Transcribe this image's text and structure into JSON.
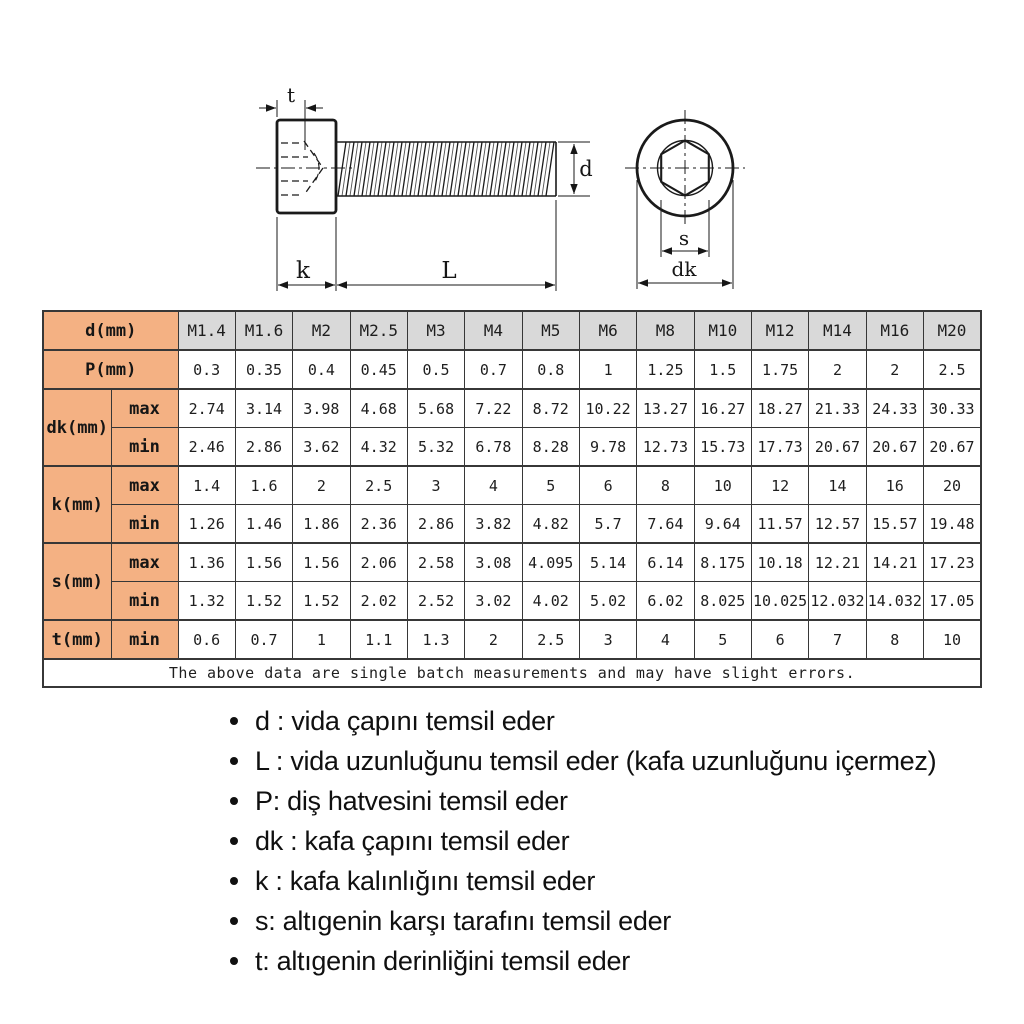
{
  "diagram": {
    "labels": {
      "t": "t",
      "d": "d",
      "k": "k",
      "L": "L",
      "s": "s",
      "dk": "dk"
    }
  },
  "table": {
    "header": {
      "label": "d(mm)",
      "sizes": [
        "M1.4",
        "M1.6",
        "M2",
        "M2.5",
        "M3",
        "M4",
        "M5",
        "M6",
        "M8",
        "M10",
        "M12",
        "M14",
        "M16",
        "M20"
      ]
    },
    "rows": [
      {
        "label": "P(mm)",
        "sub": null,
        "values": [
          "0.3",
          "0.35",
          "0.4",
          "0.45",
          "0.5",
          "0.7",
          "0.8",
          "1",
          "1.25",
          "1.5",
          "1.75",
          "2",
          "2",
          "2.5"
        ]
      },
      {
        "label": "dk(mm)",
        "sub": "max",
        "values": [
          "2.74",
          "3.14",
          "3.98",
          "4.68",
          "5.68",
          "7.22",
          "8.72",
          "10.22",
          "13.27",
          "16.27",
          "18.27",
          "21.33",
          "24.33",
          "30.33"
        ]
      },
      {
        "label": null,
        "sub": "min",
        "values": [
          "2.46",
          "2.86",
          "3.62",
          "4.32",
          "5.32",
          "6.78",
          "8.28",
          "9.78",
          "12.73",
          "15.73",
          "17.73",
          "20.67",
          "20.67",
          "20.67"
        ]
      },
      {
        "label": "k(mm)",
        "sub": "max",
        "values": [
          "1.4",
          "1.6",
          "2",
          "2.5",
          "3",
          "4",
          "5",
          "6",
          "8",
          "10",
          "12",
          "14",
          "16",
          "20"
        ]
      },
      {
        "label": null,
        "sub": "min",
        "values": [
          "1.26",
          "1.46",
          "1.86",
          "2.36",
          "2.86",
          "3.82",
          "4.82",
          "5.7",
          "7.64",
          "9.64",
          "11.57",
          "12.57",
          "15.57",
          "19.48"
        ]
      },
      {
        "label": "s(mm)",
        "sub": "max",
        "values": [
          "1.36",
          "1.56",
          "1.56",
          "2.06",
          "2.58",
          "3.08",
          "4.095",
          "5.14",
          "6.14",
          "8.175",
          "10.18",
          "12.21",
          "14.21",
          "17.23"
        ]
      },
      {
        "label": null,
        "sub": "min",
        "values": [
          "1.32",
          "1.52",
          "1.52",
          "2.02",
          "2.52",
          "3.02",
          "4.02",
          "5.02",
          "6.02",
          "8.025",
          "10.025",
          "12.032",
          "14.032",
          "17.05"
        ]
      },
      {
        "label": "t(mm)",
        "sub": "min",
        "values": [
          "0.6",
          "0.7",
          "1",
          "1.1",
          "1.3",
          "2",
          "2.5",
          "3",
          "4",
          "5",
          "6",
          "7",
          "8",
          "10"
        ]
      }
    ],
    "note": "The above data are single batch measurements and may have slight errors."
  },
  "legend": {
    "items": [
      "d : vida çapını temsil eder",
      "L : vida uzunluğunu temsil eder (kafa uzunluğunu içermez)",
      "P: diş hatvesini temsil eder",
      "dk : kafa çapını temsil eder",
      "k : kafa kalınlığını temsil eder",
      "s: altıgenin karşı tarafını temsil eder",
      "t: altıgenin derinliğini temsil eder"
    ]
  },
  "colors": {
    "label_cell": "#f4b183",
    "header_cell": "#d9d9d9",
    "table_border": "#373737",
    "line": "#1a1a1a",
    "text": "#101010",
    "background": "#ffffff"
  }
}
